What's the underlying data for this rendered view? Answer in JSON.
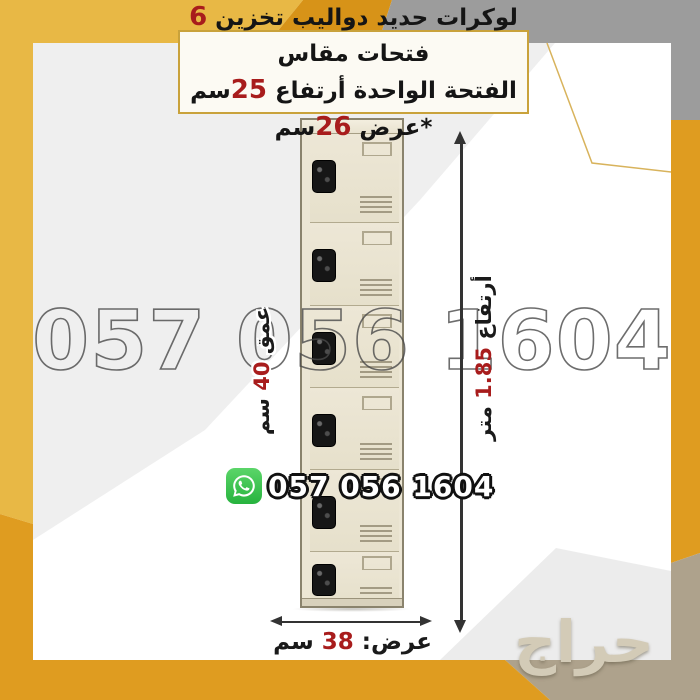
{
  "colors": {
    "gold": "#E8B845",
    "orange": "#DF9C20",
    "wedge": "#D79318",
    "gray": "#9C9C9C",
    "tan": "#AEA28C",
    "content-gray": "#EFEFEF",
    "red": "#A81C1C"
  },
  "top_box": {
    "line1": {
      "pre": "لوكرات حديد دواليب تخزين ",
      "num": "6",
      "post": " فتحات مقاس"
    },
    "line2": {
      "pre": "الفتحة الواحدة أرتفاع ",
      "num1": "25",
      "mid": "سم *عرض ",
      "num2": "26",
      "post": "سم"
    }
  },
  "watermark_phone": "057 056 1604",
  "whatsapp": {
    "icon": "whatsapp-icon",
    "number": "057 056 1604"
  },
  "dimensions": {
    "height": {
      "pre": "أرتفاع ",
      "value": "1.85",
      "post": " متر"
    },
    "depth": {
      "pre": "عمق ",
      "value": "40",
      "post": " سم"
    },
    "width": {
      "pre": "عرض: ",
      "value": "38",
      "post": " سم"
    }
  },
  "locker": {
    "door_count": 6,
    "description_icons": [
      "lock-handle",
      "label-holder",
      "vent-grille"
    ]
  },
  "haraj_watermark": "حراج"
}
